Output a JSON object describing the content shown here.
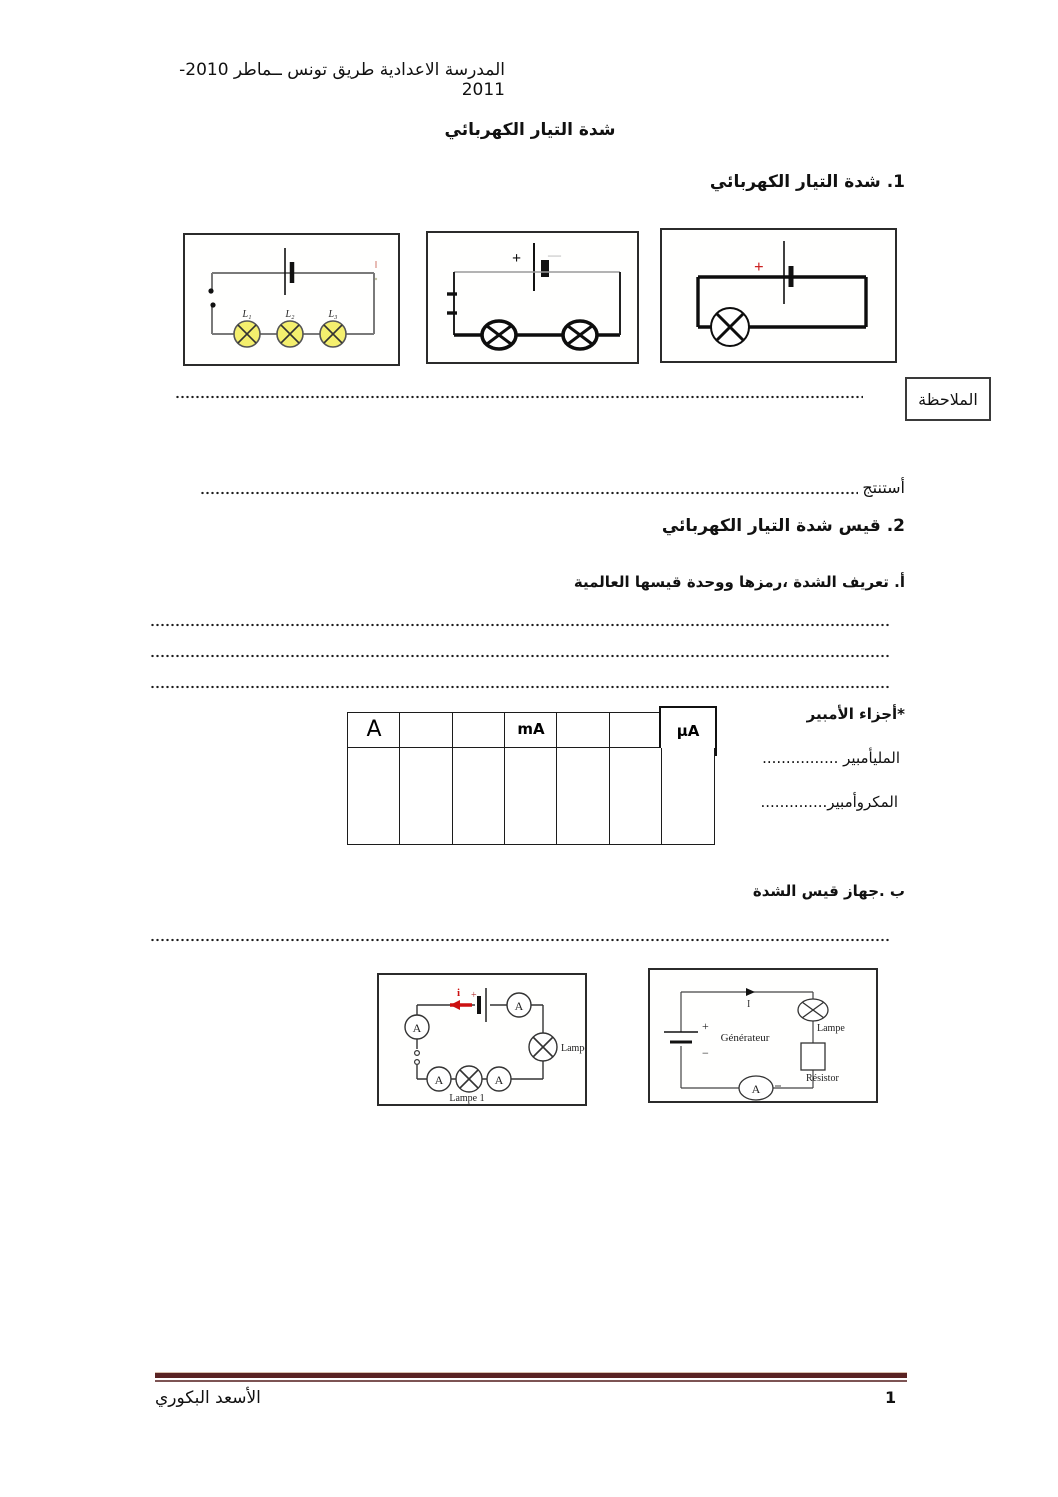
{
  "page": {
    "header": "المدرسة الاعدادية طريق تونس ــماطر 2010-2011",
    "title": "شدة التيار الكهربائي",
    "footer_name": "الأسعد البكوري",
    "footer_page": "1"
  },
  "section1": {
    "heading": "1. شدة التيار الكهربائي",
    "note_label": "الملاحظة",
    "conclusion_label": "أستنتج",
    "circuit_series_lamps": {
      "lamp1": "L₁",
      "lamp2": "L₂",
      "lamp3": "L₃"
    },
    "circuit_two_lamps": {
      "plus": "+",
      "minus": "—"
    },
    "circuit_one_lamp": {
      "plus": "+"
    }
  },
  "section2": {
    "heading": "2. قيس شدة التيار الكهربائي",
    "sub_a": "أ. تعريف الشدة ،رمزها ووحدة قيسها العالمية",
    "ampere_parts_label": "*أجزاء الأمبير",
    "milliampere_label": "المليأمبير ................",
    "microampere_label": "المكروأمبير..............",
    "unit_table": {
      "columns": [
        "A",
        "",
        "",
        "mA",
        "",
        "",
        "µA"
      ]
    },
    "sub_b": "ب .جهاز قيس الشدة",
    "circuit_ammeters": {
      "ammeter": "A",
      "current": "i",
      "plus": "+",
      "lamp1_label": "Lampe 1",
      "lamp2_label": "Lampe 2"
    },
    "circuit_generator": {
      "generator": "Générateur",
      "current": "I",
      "plus": "+",
      "minus": "−",
      "lamp": "Lampe",
      "resistor": "Résistor",
      "ammeter": "A"
    }
  }
}
